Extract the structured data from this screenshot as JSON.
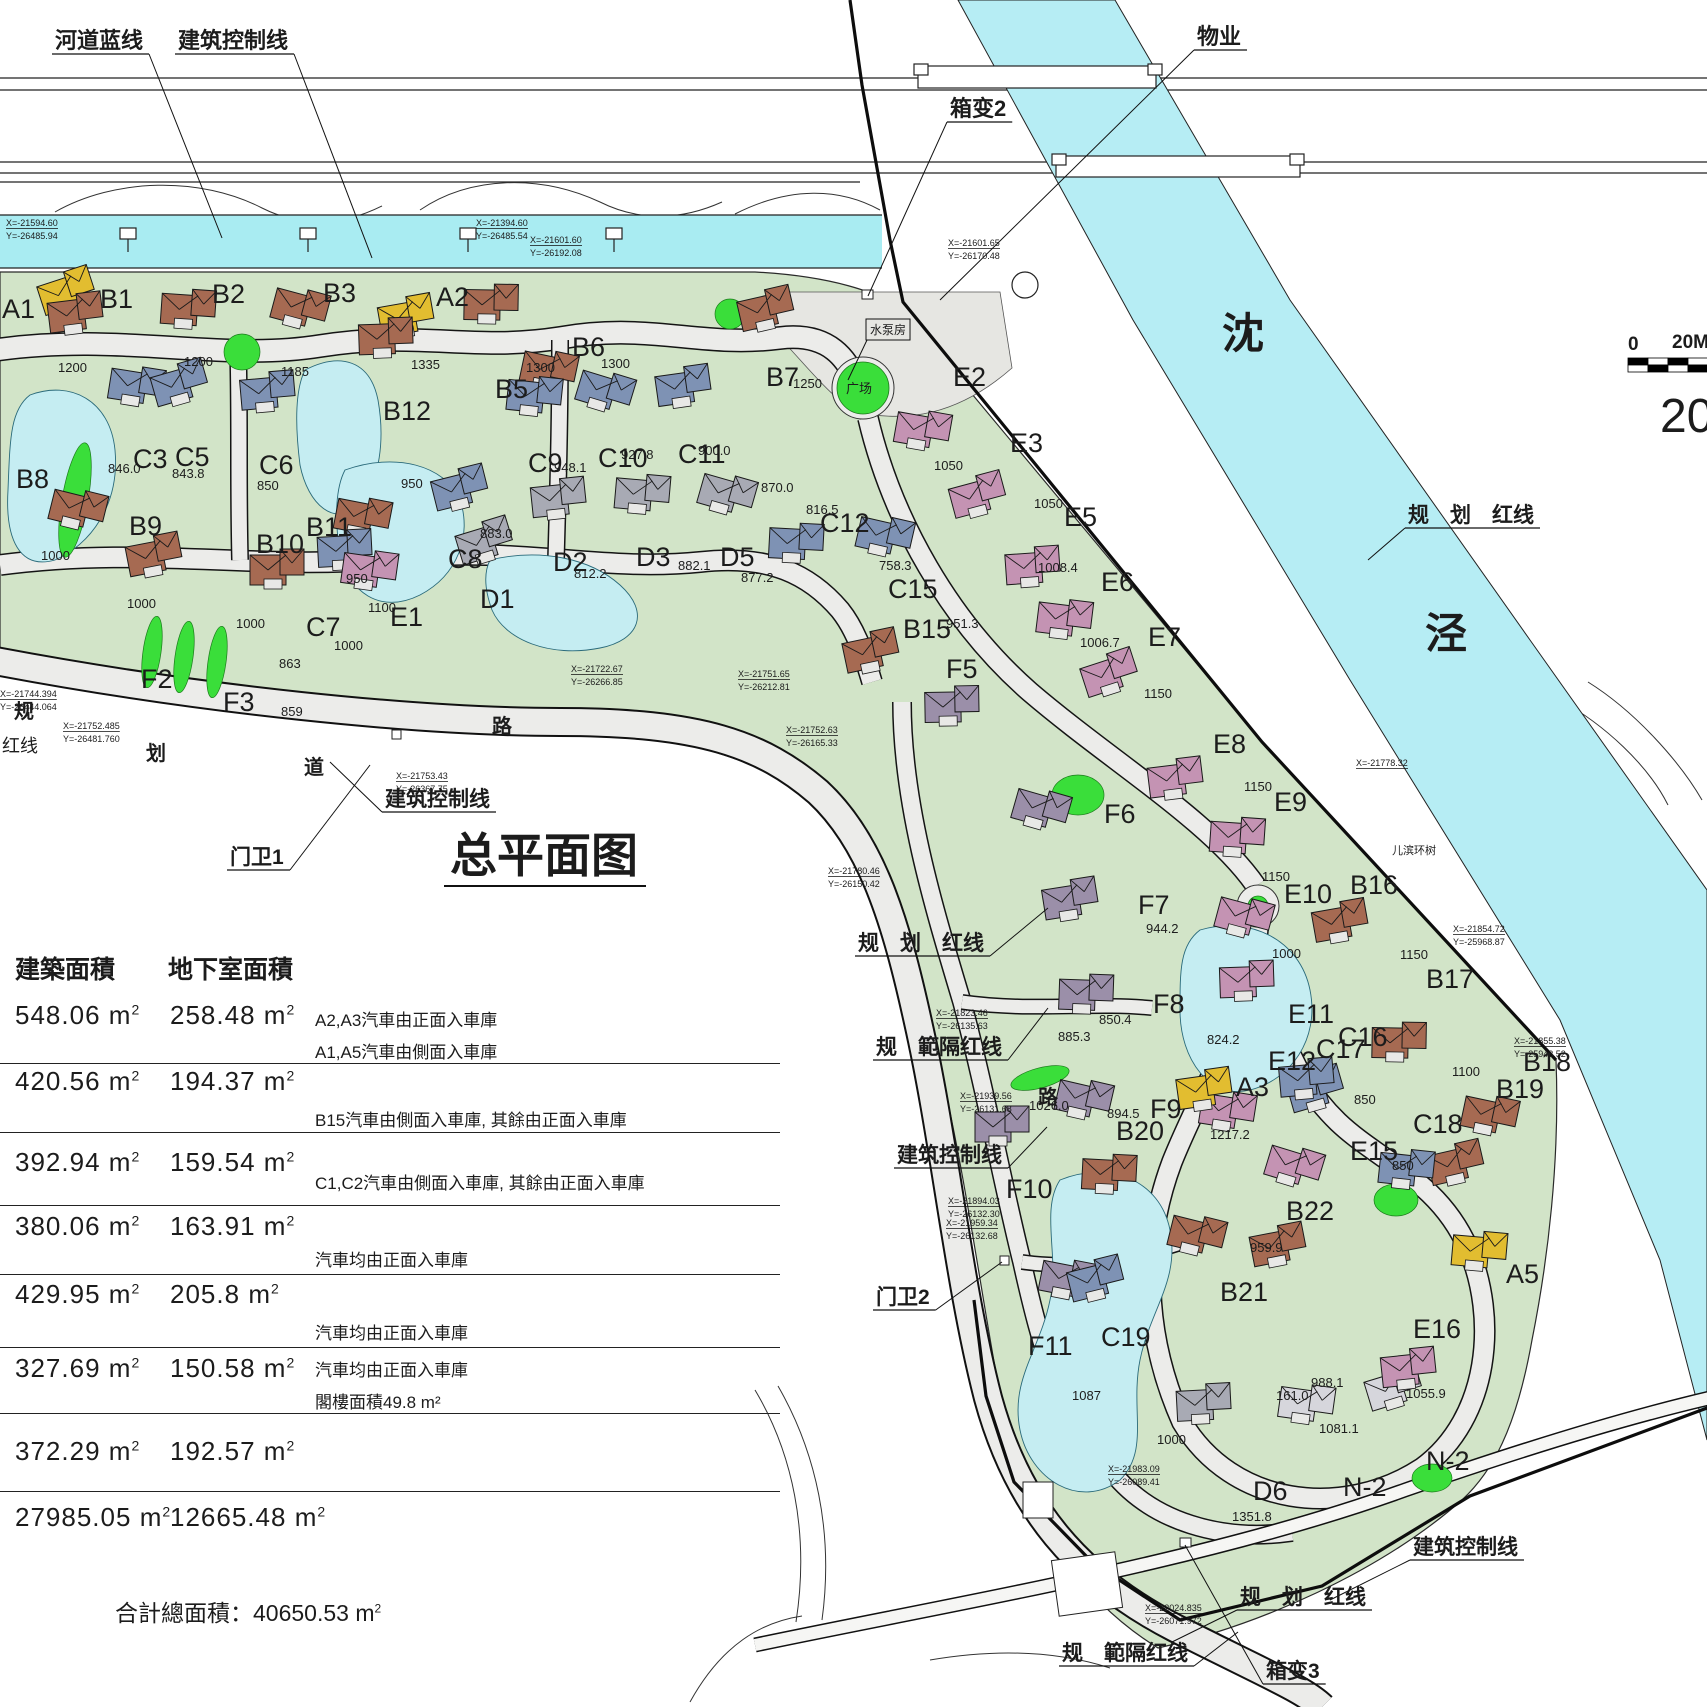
{
  "title": {
    "text": "总平面图",
    "x": 450,
    "y": 872
  },
  "units": {
    "unit": "m",
    "sup": "2"
  },
  "footer": {
    "label": "合計總面積：",
    "value": "40650.53",
    "unit": "m",
    "sup": "2"
  },
  "scale_bar": {
    "tick_start": "0",
    "tick_end": "20M",
    "big_label": "20"
  },
  "river_names": [
    {
      "c": "沈",
      "x": 1222,
      "y": 348
    },
    {
      "c": "泾",
      "x": 1425,
      "y": 648
    }
  ],
  "road_chars": [
    {
      "c": "规",
      "x": 14,
      "y": 718
    },
    {
      "c": "划",
      "x": 146,
      "y": 760
    },
    {
      "c": "道",
      "x": 304,
      "y": 774
    },
    {
      "c": "路",
      "x": 492,
      "y": 733
    },
    {
      "c": "路",
      "x": 1038,
      "y": 1104
    }
  ],
  "table": {
    "headers": [
      "建築面積",
      "地下室面積"
    ],
    "rows": [
      {
        "building": "548.06",
        "basement": "258.48",
        "notes": [
          "A2,A3汽車由正面入車庫",
          "A1,A5汽車由側面入車庫"
        ]
      },
      {
        "building": "420.56",
        "basement": "194.37",
        "notes": [
          "B15汽車由側面入車庫, 其餘由正面入車庫"
        ]
      },
      {
        "building": "392.94",
        "basement": "159.54",
        "notes": [
          "C1,C2汽車由側面入車庫, 其餘由正面入車庫"
        ]
      },
      {
        "building": "380.06",
        "basement": "163.91",
        "notes": [
          "汽車均由正面入車庫"
        ]
      },
      {
        "building": "429.95",
        "basement": "205.8",
        "notes": [
          "汽車均由正面入車庫"
        ]
      },
      {
        "building": "327.69",
        "basement": "150.58",
        "notes": [
          "汽車均由正面入車庫",
          "閣樓面積49.8 m²"
        ]
      },
      {
        "building": "372.29",
        "basement": "192.57",
        "notes": []
      },
      {
        "building": "27985.05",
        "basement": "12665.48",
        "notes": []
      }
    ]
  },
  "annotations": [
    {
      "t": "河道蓝线",
      "x": 55,
      "y": 48,
      "s": 22,
      "u": 1,
      "lx": 222,
      "ly": 238
    },
    {
      "t": "建筑控制线",
      "x": 178,
      "y": 48,
      "s": 22,
      "u": 1,
      "lx": 372,
      "ly": 258
    },
    {
      "t": "物业",
      "x": 1197,
      "y": 44,
      "s": 22,
      "u": 1,
      "lx": 940,
      "ly": 300
    },
    {
      "t": "箱变2",
      "x": 950,
      "y": 116,
      "s": 22,
      "u": 1,
      "lx": 868,
      "ly": 296
    },
    {
      "t": "水泵房",
      "x": 870,
      "y": 334,
      "s": 12,
      "box": 1,
      "lx": 848,
      "ly": 380
    },
    {
      "t": "广场",
      "x": 846,
      "y": 393,
      "s": 13
    },
    {
      "t": "规　划　红线",
      "x": 1408,
      "y": 522,
      "s": 21,
      "u": 1,
      "lx": 1368,
      "ly": 560
    },
    {
      "t": "规　划　红线",
      "x": 858,
      "y": 950,
      "s": 21,
      "u": 1,
      "lx": 1048,
      "ly": 908
    },
    {
      "t": "规　範隔红线",
      "x": 876,
      "y": 1054,
      "s": 21,
      "u": 1,
      "lx": 1048,
      "ly": 1008
    },
    {
      "t": "建筑控制线",
      "x": 897,
      "y": 1162,
      "s": 21,
      "u": 1,
      "lx": 1047,
      "ly": 1127
    },
    {
      "t": "建筑控制线",
      "x": 385,
      "y": 806,
      "s": 21,
      "u": 1,
      "lx": 330,
      "ly": 762
    },
    {
      "t": "门卫1",
      "x": 230,
      "y": 864,
      "s": 21,
      "u": 1,
      "lx": 370,
      "ly": 765
    },
    {
      "t": "门卫2",
      "x": 876,
      "y": 1304,
      "s": 21,
      "u": 1,
      "lx": 1002,
      "ly": 1262
    },
    {
      "t": "建筑控制线",
      "x": 1413,
      "y": 1554,
      "s": 21,
      "u": 1,
      "lx": 1330,
      "ly": 1600
    },
    {
      "t": "规　划　红线",
      "x": 1240,
      "y": 1604,
      "s": 21,
      "u": 1,
      "lx": 1172,
      "ly": 1642
    },
    {
      "t": "规　範隔红线",
      "x": 1062,
      "y": 1660,
      "s": 21,
      "u": 1,
      "lx": 1238,
      "ly": 1632
    },
    {
      "t": "箱变3",
      "x": 1266,
      "y": 1678,
      "s": 21,
      "u": 1,
      "lx": 1185,
      "ly": 1545
    },
    {
      "t": "儿滨环树",
      "x": 1392,
      "y": 854,
      "s": 11
    },
    {
      "t": "红线",
      "x": 2,
      "y": 752,
      "s": 18
    }
  ],
  "coords": [
    {
      "x": 6,
      "y": 226,
      "l1": "X=-21594.60",
      "l2": "Y=-26485.94"
    },
    {
      "x": 476,
      "y": 226,
      "l1": "X=-21394.60",
      "l2": "Y=-26485.54"
    },
    {
      "x": 530,
      "y": 243,
      "l1": "X=-21601.60",
      "l2": "Y=-26192.08"
    },
    {
      "x": 948,
      "y": 246,
      "l1": "X=-21601.65",
      "l2": "Y=-26170.48"
    },
    {
      "x": 571,
      "y": 672,
      "l1": "X=-21722.67",
      "l2": "Y=-26266.85"
    },
    {
      "x": 738,
      "y": 677,
      "l1": "X=-21751.65",
      "l2": "Y=-26212.81"
    },
    {
      "x": 786,
      "y": 733,
      "l1": "X=-21752.63",
      "l2": "Y=-26165.33"
    },
    {
      "x": 396,
      "y": 779,
      "l1": "X=-21753.43",
      "l2": "Y=-26367.75"
    },
    {
      "x": 63,
      "y": 729,
      "l1": "X=-21752.485",
      "l2": "Y=-26481.760"
    },
    {
      "x": 0,
      "y": 697,
      "l1": "X=-21744.394",
      "l2": "Y=-26444.064"
    },
    {
      "x": 828,
      "y": 874,
      "l1": "X=-21780.46",
      "l2": "Y=-26150.42"
    },
    {
      "x": 936,
      "y": 1016,
      "l1": "X=-21823.46",
      "l2": "Y=-26135.63"
    },
    {
      "x": 960,
      "y": 1099,
      "l1": "X=-21939.56",
      "l2": "Y=-26131.68"
    },
    {
      "x": 948,
      "y": 1204,
      "l1": "X=-21894.03",
      "l2": "Y=-26132.30"
    },
    {
      "x": 946,
      "y": 1226,
      "l1": "X=-21959.34",
      "l2": "Y=-26132.68"
    },
    {
      "x": 1108,
      "y": 1472,
      "l1": "X=-21983.09",
      "l2": "Y=-26089.41"
    },
    {
      "x": 1145,
      "y": 1611,
      "l1": "X=-22024.835",
      "l2": "Y=-26071.972"
    },
    {
      "x": 1453,
      "y": 932,
      "l1": "X=-21854.72",
      "l2": "Y=-25968.87"
    },
    {
      "x": 1514,
      "y": 1044,
      "l1": "X=-21855.38",
      "l2": "Y=-25943.52"
    },
    {
      "x": 1356,
      "y": 766,
      "l1": "X=-21778.32",
      "l2": ""
    }
  ],
  "series_colors": {
    "A": "#e2bd30",
    "B": "#a66a52",
    "C": "#7e92b4",
    "D": "#a8aab4",
    "E": "#c493b3",
    "F": "#9b8fa9",
    "N": "#d6d6dc",
    "X": "#9a9a9a"
  },
  "plots": [
    {
      "i": "A1",
      "x": 2,
      "y": 318,
      "h": [
        45,
        -12
      ]
    },
    {
      "i": "B1",
      "x": 100,
      "y": 308,
      "a": "1200",
      "ax": 58,
      "ay": 372
    },
    {
      "i": "B2",
      "x": 212,
      "y": 303,
      "a": "1200",
      "ax": 184,
      "ay": 366
    },
    {
      "i": "B3",
      "x": 323,
      "y": 302,
      "a": "1185",
      "ax": 281,
      "ay": 376
    },
    {
      "i": "A2",
      "x": 436,
      "y": 306,
      "a": "1335",
      "ax": 411,
      "ay": 369,
      "h": [
        -50,
        25
      ]
    },
    {
      "i": "B5",
      "x": 495,
      "y": 398,
      "a": "1300",
      "ax": 526,
      "ay": 372,
      "h": [
        -25,
        -80
      ]
    },
    {
      "i": "B6",
      "x": 572,
      "y": 356,
      "a": "1300",
      "ax": 601,
      "ay": 368,
      "h": [
        -45,
        28
      ]
    },
    {
      "i": "B7",
      "x": 766,
      "y": 386,
      "a": "1250",
      "ax": 793,
      "ay": 388,
      "h": [
        -20,
        -62
      ]
    },
    {
      "i": "B12",
      "x": 383,
      "y": 420,
      "a": "950",
      "ax": 401,
      "ay": 488,
      "h": [
        -18,
        -68
      ]
    },
    {
      "i": "C3",
      "x": 133,
      "y": 468,
      "a": "846.0",
      "ax": 108,
      "ay": 473,
      "h": [
        -18,
        -68
      ]
    },
    {
      "i": "C5",
      "x": 175,
      "y": 466,
      "a": "843.8",
      "ax": 172,
      "ay": 478,
      "h": [
        -15,
        -68
      ]
    },
    {
      "i": "C6",
      "x": 259,
      "y": 474,
      "a": "850",
      "ax": 257,
      "ay": 490,
      "h": [
        -12,
        -68
      ]
    },
    {
      "i": "C9",
      "x": 528,
      "y": 472,
      "a": "948.1",
      "ax": 554,
      "ay": 472,
      "h": [
        -15,
        -62
      ]
    },
    {
      "i": "C10",
      "x": 598,
      "y": 467,
      "a": "927.8",
      "ax": 621,
      "ay": 459,
      "h": [
        -15,
        -62
      ]
    },
    {
      "i": "C11",
      "x": 678,
      "y": 463,
      "a": "900.0",
      "ax": 698,
      "ay": 455,
      "h": [
        -15,
        -62
      ]
    },
    {
      "i": "C12",
      "x": 820,
      "y": 532,
      "a": "816.5",
      "ax": 806,
      "ay": 514,
      "h": [
        -45,
        25
      ]
    },
    {
      "i": "B8",
      "x": 16,
      "y": 488,
      "a": "1000",
      "ax": 41,
      "ay": 560,
      "h": [
        40,
        35
      ]
    },
    {
      "i": "B9",
      "x": 129,
      "y": 535,
      "a": "1000",
      "ax": 127,
      "ay": 608,
      "h": [
        5,
        35
      ]
    },
    {
      "i": "B10",
      "x": 256,
      "y": 553,
      "a": "1000",
      "ax": 236,
      "ay": 628,
      "h": [
        0,
        30
      ]
    },
    {
      "i": "B11",
      "x": 306,
      "y": 536,
      "a": "950",
      "ax": 346,
      "ay": 583,
      "h": [
        35,
        -5
      ]
    },
    {
      "i": "C8",
      "x": 448,
      "y": 568,
      "a": "883.0",
      "ax": 480,
      "ay": 538,
      "h": [
        -8,
        -65
      ]
    },
    {
      "i": "C7",
      "x": 306,
      "y": 636,
      "a": "1000",
      "ax": 334,
      "ay": 650,
      "h": [
        18,
        -72
      ]
    },
    {
      "i": "E1",
      "x": 390,
      "y": 626,
      "a": "1100",
      "ax": 368,
      "ay": 612,
      "h": [
        -42,
        -42
      ]
    },
    {
      "i": "D1",
      "x": 480,
      "y": 608,
      "h": [
        -15,
        -52
      ]
    },
    {
      "i": "D2",
      "x": 553,
      "y": 571,
      "a": "812.2",
      "ax": 574,
      "ay": 578,
      "h": [
        -15,
        -58
      ]
    },
    {
      "i": "D3",
      "x": 636,
      "y": 566,
      "a": "882.1",
      "ax": 678,
      "ay": 570,
      "h": [
        -15,
        -58
      ]
    },
    {
      "i": "D5",
      "x": 720,
      "y": 566,
      "a": "877.2",
      "ax": 741,
      "ay": 582,
      "h": [
        -15,
        -58
      ]
    },
    {
      "i": "F2",
      "x": 141,
      "y": 688,
      "a": "863",
      "ax": 279,
      "ay": 668,
      "nh": 1
    },
    {
      "i": "F3",
      "x": 223,
      "y": 711,
      "a": "859",
      "ax": 281,
      "ay": 716,
      "nh": 1
    },
    {
      "i": "C15",
      "x": 888,
      "y": 598,
      "a": "758.3",
      "ax": 879,
      "ay": 570,
      "h": [
        -25,
        -48
      ]
    },
    {
      "i": "B15",
      "x": 903,
      "y": 638,
      "a": "951.3",
      "ax": 946,
      "ay": 628,
      "h": [
        -52,
        28
      ]
    },
    {
      "i": "F5",
      "x": 946,
      "y": 678,
      "h": [
        -15,
        42
      ]
    },
    {
      "i": "E2",
      "x": 953,
      "y": 386,
      "a": "1050",
      "ax": 934,
      "ay": 470,
      "h": [
        -52,
        58
      ]
    },
    {
      "i": "E3",
      "x": 1010,
      "y": 452,
      "a": "1050",
      "ax": 1034,
      "ay": 508,
      "h": [
        -52,
        58
      ]
    },
    {
      "i": "E5",
      "x": 1064,
      "y": 526,
      "a": "1008.4",
      "ax": 1038,
      "ay": 572,
      "h": [
        -52,
        55
      ]
    },
    {
      "i": "E6",
      "x": 1101,
      "y": 591,
      "a": "1006.7",
      "ax": 1080,
      "ay": 647,
      "h": [
        -58,
        42
      ]
    },
    {
      "i": "E7",
      "x": 1148,
      "y": 646,
      "a": "1150",
      "ax": 1144,
      "ay": 698,
      "h": [
        -58,
        42
      ]
    },
    {
      "i": "E8",
      "x": 1213,
      "y": 753,
      "a": "1150",
      "ax": 1244,
      "ay": 791,
      "h": [
        -58,
        40
      ]
    },
    {
      "i": "E9",
      "x": 1274,
      "y": 811,
      "a": "1150",
      "ax": 1262,
      "ay": 881,
      "h": [
        -58,
        40
      ]
    },
    {
      "i": "E10",
      "x": 1284,
      "y": 903,
      "a": "1000",
      "ax": 1272,
      "ay": 958,
      "h": [
        -62,
        28
      ]
    },
    {
      "i": "B16",
      "x": 1350,
      "y": 894,
      "a": "1150",
      "ax": 1400,
      "ay": 959,
      "h": [
        -30,
        42
      ]
    },
    {
      "i": "B17",
      "x": 1426,
      "y": 988,
      "a": "1100",
      "ax": 1452,
      "ay": 1076,
      "h": [
        -48,
        68
      ]
    },
    {
      "i": "B18",
      "x": 1523,
      "y": 1071,
      "h": [
        -55,
        58
      ]
    },
    {
      "i": "B19",
      "x": 1496,
      "y": 1098,
      "h": [
        -60,
        80
      ]
    },
    {
      "i": "E11",
      "x": 1288,
      "y": 1023,
      "a": "824.2",
      "ax": 1207,
      "ay": 1044,
      "h": [
        -62,
        -28
      ]
    },
    {
      "i": "E12",
      "x": 1268,
      "y": 1070,
      "h": [
        -62,
        55
      ]
    },
    {
      "i": "C16",
      "x": 1338,
      "y": 1046,
      "a": "850",
      "ax": 1354,
      "ay": 1104,
      "h": [
        -42,
        58
      ]
    },
    {
      "i": "C17",
      "x": 1316,
      "y": 1058,
      "h": [
        -30,
        35
      ]
    },
    {
      "i": "C18",
      "x": 1413,
      "y": 1133,
      "a": "850",
      "ax": 1392,
      "ay": 1170,
      "h": [
        -28,
        50
      ]
    },
    {
      "i": "E15",
      "x": 1350,
      "y": 1160,
      "h": [
        -78,
        20
      ]
    },
    {
      "i": "A3",
      "x": 1236,
      "y": 1096,
      "a": "1217.2",
      "ax": 1210,
      "ay": 1139,
      "h": [
        -52,
        8
      ]
    },
    {
      "i": "B20",
      "x": 1116,
      "y": 1140,
      "h": [
        -28,
        48
      ]
    },
    {
      "i": "B21",
      "x": 1220,
      "y": 1301,
      "h": [
        -45,
        -52
      ]
    },
    {
      "i": "B22",
      "x": 1286,
      "y": 1220,
      "a": "959.9",
      "ax": 1250,
      "ay": 1252,
      "h": [
        -28,
        40
      ]
    },
    {
      "i": "F10",
      "x": 1006,
      "y": 1198,
      "h": [
        -25,
        -58
      ]
    },
    {
      "i": "F11",
      "x": 1028,
      "y": 1355,
      "a": "1087",
      "ax": 1072,
      "ay": 1400,
      "h": [
        18,
        -62
      ]
    },
    {
      "i": "C19",
      "x": 1101,
      "y": 1346,
      "a": "1000",
      "ax": 1157,
      "ay": 1444,
      "h": [
        -25,
        -52
      ]
    },
    {
      "i": "D6",
      "x": 1253,
      "y": 1500,
      "a": "1351.8",
      "ax": 1232,
      "ay": 1521,
      "h": [
        -70,
        -82
      ]
    },
    {
      "i": "N-2",
      "x": 1343,
      "y": 1496,
      "a": "1081.1",
      "ax": 1319,
      "ay": 1433,
      "h": [
        -58,
        -78
      ]
    },
    {
      "i": "N-2",
      "x": 1426,
      "y": 1470,
      "a": "1055.9",
      "ax": 1406,
      "ay": 1398,
      "h": [
        -52,
        -68
      ]
    },
    {
      "i": "E16",
      "x": 1413,
      "y": 1338,
      "h": [
        -25,
        45
      ]
    },
    {
      "i": "A5",
      "x": 1506,
      "y": 1283,
      "h": [
        -48,
        -18
      ]
    },
    {
      "i": "F6",
      "x": 1104,
      "y": 823,
      "h": [
        -85,
        0
      ]
    },
    {
      "i": "F7",
      "x": 1138,
      "y": 914,
      "a": "944.2",
      "ax": 1146,
      "ay": 933,
      "h": [
        -88,
        0
      ]
    },
    {
      "i": "F8",
      "x": 1153,
      "y": 1013,
      "a": "850.4",
      "ax": 1099,
      "ay": 1024,
      "h": [
        -88,
        -5
      ]
    },
    {
      "i": "F9",
      "x": 1150,
      "y": 1118,
      "a": "894.5",
      "ax": 1107,
      "ay": 1118,
      "h": [
        -88,
        -5
      ]
    },
    {
      "i": "",
      "x": 0,
      "y": 0,
      "a": "870.0",
      "ax": 761,
      "ay": 492,
      "nh": 1
    },
    {
      "i": "",
      "x": 0,
      "y": 0,
      "a": "885.3",
      "ax": 1058,
      "ay": 1041,
      "nh": 1
    },
    {
      "i": "",
      "x": 0,
      "y": 0,
      "a": "1026.0",
      "ax": 1029,
      "ay": 1110,
      "nh": 1
    },
    {
      "i": "",
      "x": 0,
      "y": 0,
      "a": "988.1",
      "ax": 1311,
      "ay": 1387,
      "nh": 1
    },
    {
      "i": "",
      "x": 0,
      "y": 0,
      "a": "161.0",
      "ax": 1276,
      "ay": 1400,
      "nh": 1
    }
  ]
}
